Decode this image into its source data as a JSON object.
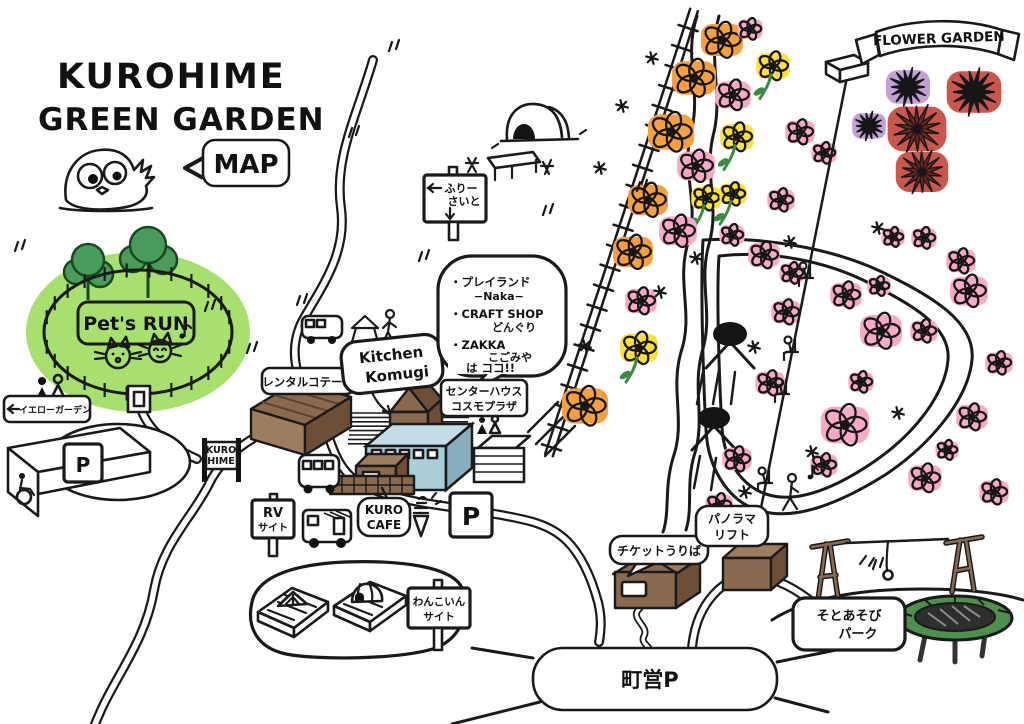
{
  "header": {
    "title_line1": "KUROHIME",
    "title_line2": "GREEN GARDEN",
    "map_bubble": "MAP"
  },
  "banner": {
    "flower_garden": "FLOWER GARDEN"
  },
  "signs": {
    "pets_run": "Pet's RUN",
    "yellow_garden": "イエローガーデン",
    "parking_west": "P",
    "parking_center": "P",
    "town_parking": "町営P",
    "free_site_line1": "ふりー",
    "free_site_line2": "さいと",
    "rental_cottage": "レンタルコテージ",
    "kitchen_line1": "Kitchen",
    "kitchen_line2": "Komugi",
    "info_lines": [
      "・プレイランド",
      "−Naka−",
      "・CRAFT SHOP",
      "どんぐり",
      "・ZAKKA",
      "こごみや",
      "は ココ!!"
    ],
    "center_house_line1": "センターハウス",
    "center_house_line2": "コスモプラザ",
    "kurohime_line1": "KURO",
    "kurohime_line2": "HIME",
    "rv_line1": "RV",
    "rv_line2": "サイト",
    "cafe_line1": "KURO",
    "cafe_line2": "CAFE",
    "wanko_line1": "わんこいん",
    "wanko_line2": "サイト",
    "ticket_office": "チケットうりば",
    "lift_line1": "パノラマ",
    "lift_line2": "リフト",
    "park_line1": "そとあそび",
    "park_line2": "パーク"
  },
  "colors": {
    "area_green": "#a7e06f",
    "tree_green": "#4a9b5a",
    "blue_building": "#a9cdd9",
    "brown": "#8a6a4e",
    "brown_dark": "#6d4f37",
    "brown_light": "#9d7d5e",
    "trampoline_green": "#4f8f4c",
    "dahlia_dark_red": "#6f2722",
    "flower": {
      "orange": "#f5a03c",
      "pink": "#f9a8c8",
      "yellow": "#ffe13a",
      "purple": "#c2a2d6",
      "red": "#c9574c"
    }
  },
  "flowers": [
    {
      "x": 722,
      "y": 40,
      "r": 20,
      "c": "orange",
      "g": "p5"
    },
    {
      "x": 750,
      "y": 29,
      "r": 12,
      "c": "pink",
      "g": "p5"
    },
    {
      "x": 694,
      "y": 78,
      "r": 21,
      "c": "orange",
      "g": "p5"
    },
    {
      "x": 773,
      "y": 66,
      "r": 16,
      "c": "yellow",
      "g": "ds"
    },
    {
      "x": 733,
      "y": 95,
      "r": 17,
      "c": "pink",
      "g": "p5"
    },
    {
      "x": 671,
      "y": 132,
      "r": 22,
      "c": "orange",
      "g": "p5"
    },
    {
      "x": 737,
      "y": 137,
      "r": 16,
      "c": "yellow",
      "g": "ds"
    },
    {
      "x": 696,
      "y": 166,
      "r": 18,
      "c": "pink",
      "g": "p5"
    },
    {
      "x": 648,
      "y": 200,
      "r": 19,
      "c": "orange",
      "g": "p5"
    },
    {
      "x": 706,
      "y": 198,
      "r": 14,
      "c": "yellow",
      "g": "ds"
    },
    {
      "x": 733,
      "y": 194,
      "r": 13,
      "c": "yellow",
      "g": "ds"
    },
    {
      "x": 678,
      "y": 231,
      "r": 18,
      "c": "pink",
      "g": "p5"
    },
    {
      "x": 633,
      "y": 252,
      "r": 19,
      "c": "orange",
      "g": "p5"
    },
    {
      "x": 641,
      "y": 301,
      "r": 15,
      "c": "pink",
      "g": "p5"
    },
    {
      "x": 639,
      "y": 348,
      "r": 18,
      "c": "yellow",
      "g": "ds"
    },
    {
      "x": 585,
      "y": 406,
      "r": 22,
      "c": "orange",
      "g": "p5"
    },
    {
      "x": 732,
      "y": 235,
      "r": 12,
      "c": "pink",
      "g": "p5"
    },
    {
      "x": 764,
      "y": 255,
      "r": 15,
      "c": "pink",
      "g": "p5"
    },
    {
      "x": 792,
      "y": 273,
      "r": 12,
      "c": "pink",
      "g": "p5"
    },
    {
      "x": 786,
      "y": 312,
      "r": 14,
      "c": "pink",
      "g": "p5"
    },
    {
      "x": 846,
      "y": 295,
      "r": 15,
      "c": "pink",
      "g": "p5"
    },
    {
      "x": 879,
      "y": 286,
      "r": 11,
      "c": "pink",
      "g": "p5"
    },
    {
      "x": 881,
      "y": 331,
      "r": 20,
      "c": "pink",
      "g": "p5"
    },
    {
      "x": 924,
      "y": 331,
      "r": 13,
      "c": "pink",
      "g": "p5"
    },
    {
      "x": 969,
      "y": 291,
      "r": 18,
      "c": "pink",
      "g": "p5"
    },
    {
      "x": 999,
      "y": 363,
      "r": 13,
      "c": "pink",
      "g": "p5"
    },
    {
      "x": 770,
      "y": 383,
      "r": 14,
      "c": "pink",
      "g": "p5"
    },
    {
      "x": 861,
      "y": 382,
      "r": 12,
      "c": "pink",
      "g": "p5"
    },
    {
      "x": 845,
      "y": 425,
      "r": 23,
      "c": "pink",
      "g": "p5"
    },
    {
      "x": 824,
      "y": 465,
      "r": 13,
      "c": "pink",
      "g": "p5"
    },
    {
      "x": 947,
      "y": 450,
      "r": 11,
      "c": "pink",
      "g": "p5"
    },
    {
      "x": 972,
      "y": 417,
      "r": 15,
      "c": "pink",
      "g": "p5"
    },
    {
      "x": 961,
      "y": 261,
      "r": 14,
      "c": "pink",
      "g": "p5"
    },
    {
      "x": 924,
      "y": 238,
      "r": 12,
      "c": "pink",
      "g": "p5"
    },
    {
      "x": 893,
      "y": 237,
      "r": 11,
      "c": "pink",
      "g": "p5"
    },
    {
      "x": 737,
      "y": 459,
      "r": 14,
      "c": "pink",
      "g": "p5"
    },
    {
      "x": 925,
      "y": 478,
      "r": 16,
      "c": "pink",
      "g": "p5"
    },
    {
      "x": 994,
      "y": 492,
      "r": 14,
      "c": "pink",
      "g": "p5"
    },
    {
      "x": 719,
      "y": 505,
      "r": 13,
      "c": "pink",
      "g": "p5"
    },
    {
      "x": 800,
      "y": 132,
      "r": 14,
      "c": "pink",
      "g": "p5"
    },
    {
      "x": 824,
      "y": 153,
      "r": 12,
      "c": "pink",
      "g": "p5"
    },
    {
      "x": 781,
      "y": 200,
      "r": 13,
      "c": "pink",
      "g": "p5"
    },
    {
      "x": 908,
      "y": 87,
      "r": 21,
      "c": "purple",
      "g": "dhl"
    },
    {
      "x": 974,
      "y": 92,
      "r": 26,
      "c": "red",
      "g": "dhl"
    },
    {
      "x": 869,
      "y": 126,
      "r": 16,
      "c": "purple",
      "g": "dhl"
    },
    {
      "x": 917,
      "y": 129,
      "r": 28,
      "c": "red",
      "g": "dhlD"
    },
    {
      "x": 922,
      "y": 172,
      "r": 25,
      "c": "red",
      "g": "dhlD"
    }
  ],
  "sparkles": [
    [
      652,
      58
    ],
    [
      622,
      106
    ],
    [
      600,
      168
    ],
    [
      660,
      292
    ],
    [
      696,
      258
    ],
    [
      585,
      346
    ],
    [
      790,
      242
    ],
    [
      754,
      347
    ],
    [
      898,
      413
    ],
    [
      812,
      452
    ],
    [
      745,
      492
    ],
    [
      878,
      228
    ]
  ],
  "ticks": [
    [
      392,
      42
    ],
    [
      352,
      128
    ],
    [
      18,
      242
    ],
    [
      300,
      296
    ],
    [
      422,
      252
    ],
    [
      546,
      206
    ],
    [
      250,
      344
    ],
    [
      876,
      560
    ],
    [
      208,
      302
    ],
    [
      640,
      182
    ]
  ],
  "lift_riders": [
    [
      810,
      264
    ],
    [
      795,
      338
    ],
    [
      786,
      380
    ],
    [
      769,
      469
    ]
  ]
}
